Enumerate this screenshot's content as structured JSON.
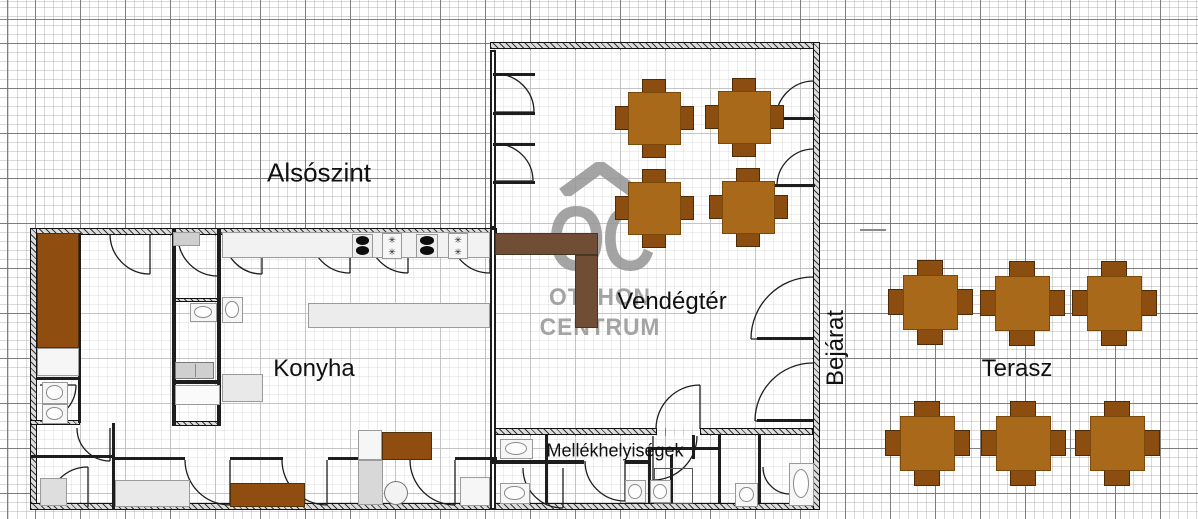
{
  "plan_title": "Alsószint",
  "watermark": {
    "initials": "OC",
    "line1": "OTTHON",
    "line2": "CENTRUM"
  },
  "symbols": {
    "gas_burner": "✳"
  },
  "labels": [
    {
      "id": "alsoszint",
      "text": "Alsószint",
      "x": 319,
      "y": 173,
      "size": 26,
      "rotate": 0
    },
    {
      "id": "vendegter",
      "text": "Vendégtér",
      "x": 672,
      "y": 302,
      "size": 24,
      "rotate": 0
    },
    {
      "id": "konyha",
      "text": "Konyha",
      "x": 314,
      "y": 369,
      "size": 24,
      "rotate": 0
    },
    {
      "id": "bejarat",
      "text": "Bejárat",
      "x": 836,
      "y": 348,
      "size": 24,
      "rotate": -90
    },
    {
      "id": "terasz",
      "text": "Terasz",
      "x": 1017,
      "y": 369,
      "size": 24,
      "rotate": 0
    },
    {
      "id": "mellekhelyisegek",
      "text": "Mellékhelyiségek",
      "x": 615,
      "y": 451,
      "size": 18,
      "rotate": 0
    }
  ],
  "colors": {
    "table_top": "#A8691A",
    "chair": "#8B4E10",
    "table_edge": "#7a480b",
    "chair_edge": "#4c2b06",
    "wood": "#8F4D10",
    "wood_edge": "#50300a",
    "bar": "#6F4E35",
    "bar_edge": "#463626",
    "watermark": "#b5b5b5",
    "wall": "#1d1d1d"
  },
  "tables": [
    {
      "area": "vendegter",
      "size": 53,
      "chair_w": 24,
      "chair_h": 16,
      "centers": [
        [
          654,
          118
        ],
        [
          744,
          117
        ],
        [
          654,
          208
        ],
        [
          748,
          207
        ]
      ]
    },
    {
      "area": "terasz",
      "size": 55,
      "chair_w": 26,
      "chair_h": 18,
      "centers": [
        [
          930,
          302
        ],
        [
          1022,
          303
        ],
        [
          1114,
          303
        ],
        [
          927,
          443
        ],
        [
          1023,
          443
        ],
        [
          1117,
          443
        ]
      ]
    }
  ],
  "structure": {
    "floors": [
      [
        37,
        236,
        453,
        266
      ],
      [
        496,
        50,
        316,
        378
      ],
      [
        496,
        436,
        316,
        66
      ]
    ],
    "outer_walls": [
      [
        30,
        228,
        467,
        7
      ],
      [
        30,
        228,
        7,
        282
      ],
      [
        30,
        503,
        790,
        7
      ],
      [
        490,
        42,
        330,
        7
      ],
      [
        813,
        42,
        7,
        468
      ],
      [
        490,
        428,
        167,
        7
      ],
      [
        700,
        428,
        113,
        7
      ],
      [
        30,
        420,
        50,
        5
      ],
      [
        172,
        298,
        49,
        4
      ],
      [
        172,
        421,
        49,
        5
      ]
    ],
    "double_walls": [
      [
        490,
        50,
        6,
        178
      ],
      [
        490,
        228,
        6,
        282
      ]
    ],
    "inner_walls": [
      [
        78,
        233,
        3,
        190
      ],
      [
        37,
        377,
        42,
        3
      ],
      [
        112,
        423,
        3,
        87
      ],
      [
        30,
        455,
        84,
        3
      ],
      [
        172,
        228,
        4,
        198
      ],
      [
        217,
        228,
        4,
        198
      ],
      [
        172,
        380,
        49,
        4
      ],
      [
        112,
        457,
        73,
        3
      ],
      [
        230,
        457,
        53,
        3
      ],
      [
        328,
        457,
        82,
        3
      ],
      [
        455,
        457,
        42,
        3
      ],
      [
        493,
        73,
        42,
        3
      ],
      [
        493,
        112,
        42,
        3
      ],
      [
        493,
        143,
        42,
        3
      ],
      [
        493,
        181,
        42,
        3
      ],
      [
        775,
        117,
        40,
        3
      ],
      [
        775,
        184,
        40,
        3
      ],
      [
        757,
        337,
        56,
        3
      ],
      [
        757,
        419,
        56,
        3
      ],
      [
        545,
        435,
        3,
        68
      ],
      [
        648,
        447,
        3,
        56
      ],
      [
        670,
        455,
        3,
        48
      ],
      [
        692,
        435,
        3,
        24
      ],
      [
        718,
        435,
        3,
        68
      ],
      [
        758,
        435,
        3,
        68
      ],
      [
        492,
        460,
        92,
        4
      ],
      [
        625,
        460,
        26,
        4
      ],
      [
        648,
        447,
        72,
        3
      ]
    ],
    "light_walls": [
      [
        860,
        229,
        26,
        2
      ]
    ],
    "doors": [
      [
        150,
        234,
        40,
        "W",
        "S"
      ],
      [
        218,
        236,
        40,
        "W",
        "S"
      ],
      [
        262,
        236,
        38,
        "W",
        "S"
      ],
      [
        350,
        233,
        40,
        "W",
        "S"
      ],
      [
        408,
        233,
        40,
        "W",
        "S"
      ],
      [
        490,
        233,
        40,
        "W",
        "S"
      ],
      [
        110,
        428,
        33,
        "W",
        "S"
      ],
      [
        88,
        507,
        40,
        "W",
        "N"
      ],
      [
        230,
        460,
        45,
        "W",
        "S"
      ],
      [
        327,
        460,
        45,
        "W",
        "S"
      ],
      [
        455,
        460,
        45,
        "W",
        "S"
      ],
      [
        40,
        385,
        36,
        "S",
        "E"
      ],
      [
        496,
        112,
        38,
        "N",
        "E"
      ],
      [
        496,
        181,
        37,
        "N",
        "E"
      ],
      [
        814,
        119,
        38,
        "N",
        "W"
      ],
      [
        814,
        186,
        37,
        "N",
        "W"
      ],
      [
        813,
        339,
        62,
        "N",
        "W"
      ],
      [
        813,
        421,
        58,
        "N",
        "W"
      ],
      [
        700,
        429,
        44,
        "W",
        "N"
      ],
      [
        653,
        436,
        44,
        "E",
        "S"
      ],
      [
        563,
        468,
        40,
        "W",
        "S"
      ],
      [
        625,
        461,
        40,
        "W",
        "S"
      ],
      [
        790,
        467,
        27,
        "W",
        "S"
      ]
    ],
    "fixtures": [
      {
        "t": "counter",
        "r": [
          222,
          232,
          268,
          26
        ],
        "f": "#f2f2f2"
      },
      {
        "t": "counter",
        "r": [
          308,
          303,
          182,
          25
        ],
        "f": "#ececec"
      },
      {
        "t": "counter",
        "r": [
          173,
          232,
          27,
          14
        ],
        "f": "#cfcfcf"
      },
      {
        "t": "counter",
        "r": [
          37,
          348,
          42,
          28
        ],
        "f": "#f6f6f6"
      },
      {
        "t": "counter",
        "r": [
          222,
          374,
          41,
          28
        ],
        "f": "#e9e9e9"
      },
      {
        "t": "counter",
        "r": [
          175,
          385,
          45,
          20
        ],
        "f": "#fafafa"
      },
      {
        "t": "counter",
        "r": [
          40,
          478,
          27,
          28
        ],
        "f": "#dedede"
      },
      {
        "t": "counter",
        "r": [
          115,
          480,
          75,
          27
        ],
        "f": "#e9e9e9"
      },
      {
        "t": "counter",
        "r": [
          358,
          430,
          24,
          30
        ],
        "f": "#f6f6f6"
      },
      {
        "t": "counter",
        "r": [
          358,
          460,
          25,
          45
        ],
        "f": "#d8d8d8"
      },
      {
        "t": "counter",
        "r": [
          460,
          477,
          30,
          29
        ],
        "f": "#f6f6f6"
      },
      {
        "t": "washer",
        "r": [
          175,
          362,
          39,
          17
        ]
      },
      {
        "t": "shower",
        "r": [
          654,
          468,
          39,
          36
        ]
      },
      {
        "t": "circle",
        "r": [
          384,
          481,
          24,
          24
        ]
      },
      {
        "t": "toilet",
        "r": [
          42,
          382,
          26,
          22
        ]
      },
      {
        "t": "toilet",
        "r": [
          42,
          404,
          26,
          20
        ]
      },
      {
        "t": "toilet",
        "r": [
          190,
          303,
          27,
          19
        ]
      },
      {
        "t": "toilet",
        "r": [
          500,
          439,
          33,
          20
        ]
      },
      {
        "t": "toilet",
        "r": [
          500,
          483,
          30,
          21
        ]
      },
      {
        "t": "toilet",
        "r": [
          735,
          483,
          23,
          24
        ]
      },
      {
        "t": "toilet",
        "r": [
          789,
          463,
          25,
          43
        ]
      },
      {
        "t": "sink",
        "r": [
          222,
          297,
          21,
          26
        ]
      },
      {
        "t": "sink",
        "r": [
          625,
          480,
          21,
          23
        ]
      },
      {
        "t": "sink",
        "r": [
          650,
          480,
          21,
          23
        ]
      },
      {
        "t": "stove",
        "r": [
          352,
          234,
          21,
          24
        ]
      },
      {
        "t": "stove",
        "r": [
          416,
          234,
          22,
          24
        ]
      },
      {
        "t": "gas",
        "r": [
          382,
          233,
          20,
          26
        ]
      },
      {
        "t": "gas",
        "r": [
          448,
          233,
          20,
          26
        ]
      },
      {
        "t": "wood",
        "r": [
          37,
          233,
          42,
          115
        ]
      },
      {
        "t": "wood",
        "r": [
          382,
          432,
          50,
          28
        ]
      },
      {
        "t": "wood",
        "r": [
          230,
          483,
          75,
          24
        ]
      },
      {
        "t": "bar",
        "r": [
          495,
          233,
          103,
          22
        ]
      },
      {
        "t": "bar",
        "r": [
          575,
          255,
          23,
          73
        ]
      }
    ]
  }
}
